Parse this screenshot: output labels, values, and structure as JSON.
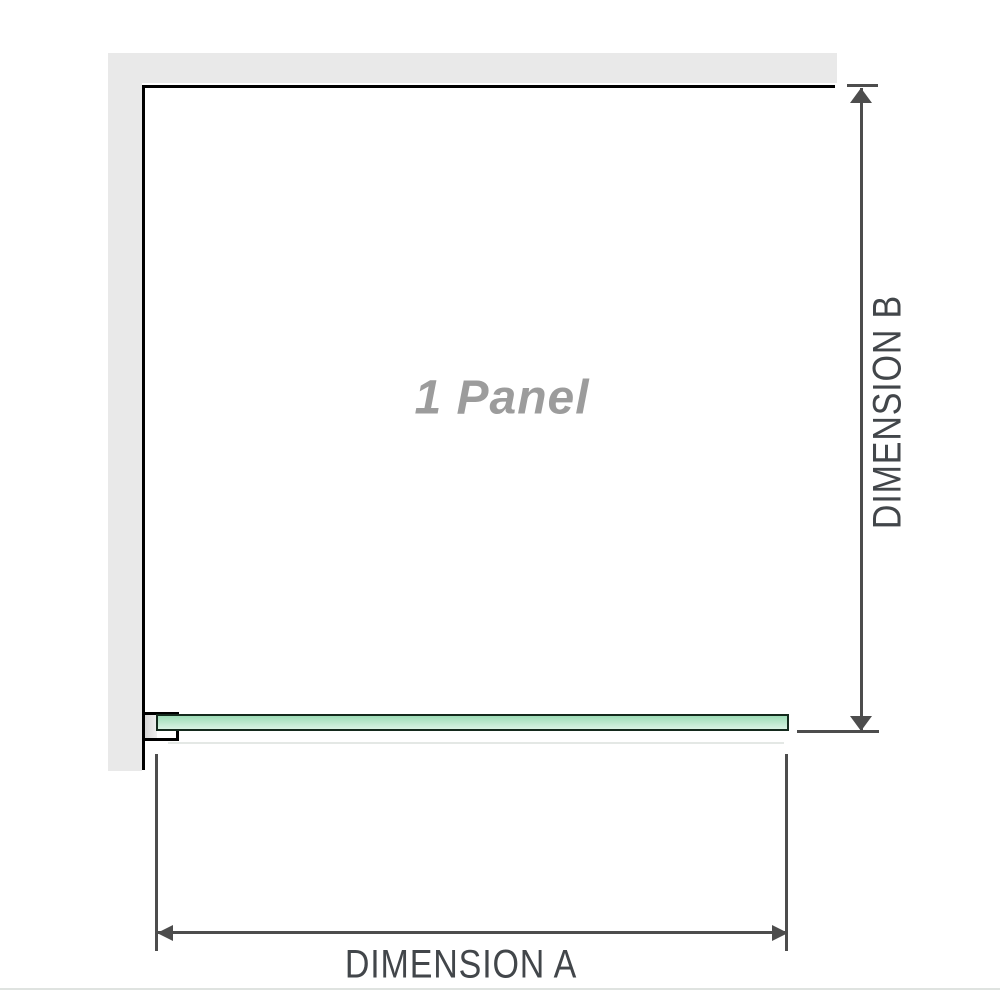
{
  "diagram": {
    "title_hint": "shower screen single panel dimension diagram",
    "panel_label": "1 Panel",
    "dimension_a_label": "DIMENSION A",
    "dimension_b_label": "DIMENSION B"
  },
  "colors": {
    "wall_fill": "#e9e9e9",
    "wall_edge": "#000000",
    "glass_border": "#142a1d",
    "glass_fill_top": "#9edcb7",
    "glass_fill_bottom": "#d9f3e4",
    "bracket_outline": "#000000",
    "bracket_pad": "#d7d7d7",
    "dimension_lines": "#4d4d4d",
    "dimension_label_text": "#42464a",
    "panel_label_text": "#9c9c9c",
    "bottom_divider": "#dfe3e0"
  }
}
